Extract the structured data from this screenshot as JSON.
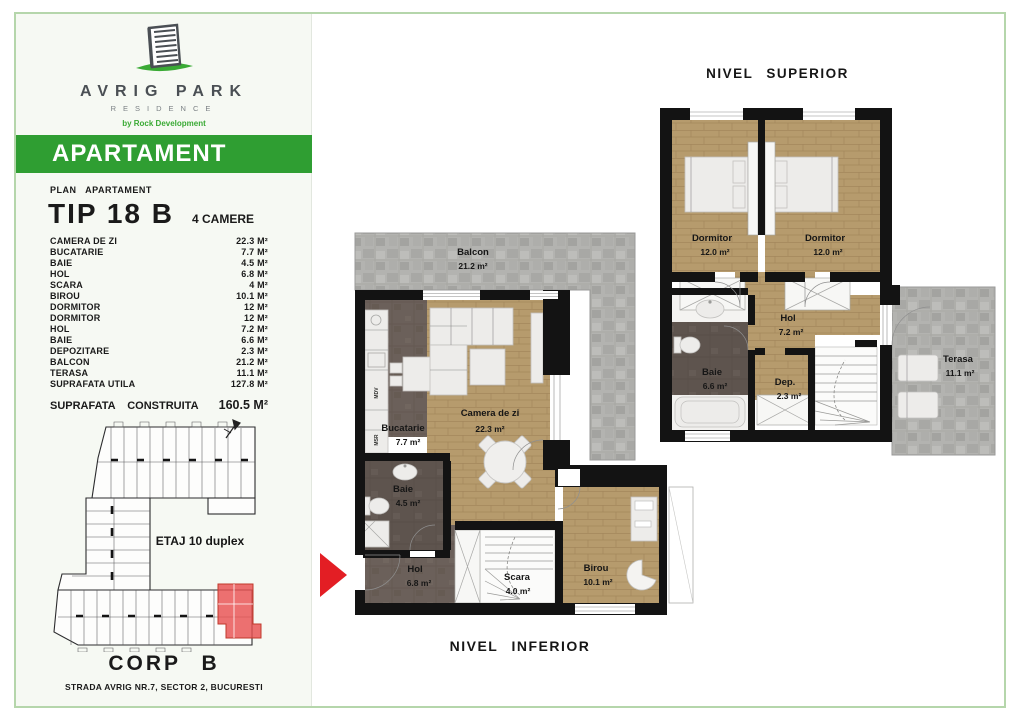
{
  "colors": {
    "accent_green": "#2f9e32",
    "frame_green": "#b5d6ab",
    "logo_gray": "#4a4f54",
    "logo_swoosh_green": "#3aaa35",
    "wood_floor": "#b69b6d",
    "dark_floor": "#6b605a",
    "stone_gray": "#b3b3b0",
    "wall_black": "#131313",
    "marker_red": "#e31e24"
  },
  "sidebar": {
    "brand": {
      "name": "AVRIG PARK",
      "residence": "RESIDENCE",
      "tagline": "by Rock Development"
    },
    "banner": "APARTAMENT",
    "plan_label": "PLAN APARTAMENT",
    "tip": "TIP 18 B",
    "camere": "4 CAMERE",
    "rooms": [
      {
        "name": "CAMERA DE ZI",
        "area": "22.3 M²"
      },
      {
        "name": "BUCATARIE",
        "area": "7.7 M²"
      },
      {
        "name": "BAIE",
        "area": "4.5 M²"
      },
      {
        "name": "HOL",
        "area": "6.8 M²"
      },
      {
        "name": "SCARA",
        "area": "4 M²"
      },
      {
        "name": "BIROU",
        "area": "10.1 M²"
      },
      {
        "name": "DORMITOR",
        "area": "12 M²"
      },
      {
        "name": "DORMITOR",
        "area": "12 M²"
      },
      {
        "name": "HOL",
        "area": "7.2 M²"
      },
      {
        "name": "BAIE",
        "area": "6.6 M²"
      },
      {
        "name": "DEPOZITARE",
        "area": "2.3 M²"
      },
      {
        "name": "BALCON",
        "area": "21.2 M²"
      },
      {
        "name": "TERASA",
        "area": "11.1 M²"
      },
      {
        "name": "SUPRAFATA UTILA",
        "area": "127.8 M²"
      }
    ],
    "total_label": "SUPRAFATA CONSTRUITA",
    "total_value": "160.5 M²",
    "siteplan": {
      "floor_label": "ETAJ 10 duplex",
      "corp": "CORP B",
      "address": "STRADA AVRIG NR.7, SECTOR 2, BUCURESTI"
    }
  },
  "plans": {
    "superior": {
      "title": "NIVEL SUPERIOR",
      "dormitor_left": {
        "name": "Dormitor",
        "area": "12.0 m²"
      },
      "dormitor_right": {
        "name": "Dormitor",
        "area": "12.0 m²"
      },
      "hol": {
        "name": "Hol",
        "area": "7.2 m²"
      },
      "baie": {
        "name": "Baie",
        "area": "6.6 m²"
      },
      "dep": {
        "name": "Dep.",
        "area": "2.3 m²"
      },
      "terasa": {
        "name": "Terasa",
        "area": "11.1 m²"
      }
    },
    "inferior": {
      "title": "NIVEL INFERIOR",
      "balcon": {
        "name": "Balcon",
        "area": "21.2 m²"
      },
      "bucatarie": {
        "name": "Bucatarie",
        "area": "7.7 m²"
      },
      "camera_de_zi": {
        "name": "Camera de zi",
        "area": "22.3 m²"
      },
      "baie": {
        "name": "Baie",
        "area": "4.5 m²"
      },
      "hol": {
        "name": "Hol",
        "area": "6.8 m²"
      },
      "scara": {
        "name": "Scara",
        "area": "4.0 m²"
      },
      "birou": {
        "name": "Birou",
        "area": "10.1 m²"
      },
      "appliances": [
        "MDV",
        "MSR"
      ]
    }
  }
}
